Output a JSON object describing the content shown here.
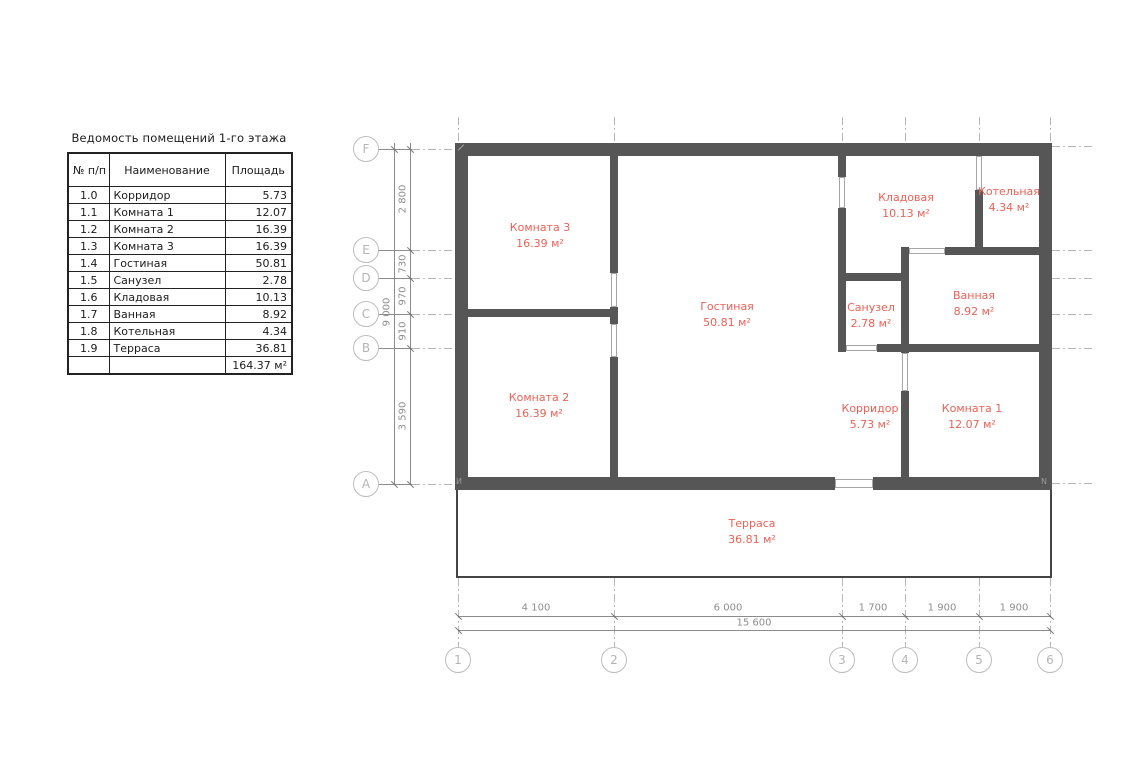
{
  "table": {
    "title": "Ведомость помещений 1-го этажа",
    "headers": {
      "num": "№ п/п",
      "name": "Наименование",
      "area": "Площадь"
    },
    "rows": [
      {
        "num": "1.0",
        "name": "Корридор",
        "area": "5.73"
      },
      {
        "num": "1.1",
        "name": "Комната 1",
        "area": "12.07"
      },
      {
        "num": "1.2",
        "name": "Комната 2",
        "area": "16.39"
      },
      {
        "num": "1.3",
        "name": "Комната 3",
        "area": "16.39"
      },
      {
        "num": "1.4",
        "name": "Гостиная",
        "area": "50.81"
      },
      {
        "num": "1.5",
        "name": "Санузел",
        "area": "2.78"
      },
      {
        "num": "1.6",
        "name": "Кладовая",
        "area": "10.13"
      },
      {
        "num": "1.7",
        "name": "Ванная",
        "area": "8.92"
      },
      {
        "num": "1.8",
        "name": "Котельная",
        "area": "4.34"
      },
      {
        "num": "1.9",
        "name": "Терраса",
        "area": "36.81"
      },
      {
        "num": "",
        "name": "",
        "area": "164.37 м²"
      }
    ]
  },
  "plan": {
    "rooms": {
      "komnata3": {
        "name": "Комната 3",
        "area": "16.39 м²"
      },
      "komnata2": {
        "name": "Комната 2",
        "area": "16.39 м²"
      },
      "gostinaya": {
        "name": "Гостиная",
        "area": "50.81 м²"
      },
      "kladovaya": {
        "name": "Кладовая",
        "area": "10.13 м²"
      },
      "kotelnaya": {
        "name": "Котельная",
        "area": "4.34 м²"
      },
      "sanuzel": {
        "name": "Санузел",
        "area": "2.78 м²"
      },
      "vannaya": {
        "name": "Ванная",
        "area": "8.92 м²"
      },
      "korridor": {
        "name": "Корридор",
        "area": "5.73 м²"
      },
      "komnata1": {
        "name": "Комната 1",
        "area": "12.07 м²"
      },
      "terrasa": {
        "name": "Терраса",
        "area": "36.81 м²"
      }
    },
    "axes": {
      "rows": [
        "F",
        "E",
        "D",
        "C",
        "B",
        "A"
      ],
      "cols": [
        "1",
        "2",
        "3",
        "4",
        "5",
        "6"
      ]
    },
    "dims": {
      "left_segments": [
        "2 800",
        "730",
        "970",
        "910",
        "3 590"
      ],
      "left_total": "9 000",
      "bottom_segments": [
        "4 100",
        "6 000",
        "1 700",
        "1 900",
        "1 900"
      ],
      "bottom_total": "15 600"
    },
    "corner_marks": {
      "bottom_left": "И",
      "bottom_right": "N"
    }
  },
  "colors": {
    "wall": "#565656",
    "room_label": "#ee6156",
    "dim_line": "#8c8c8c",
    "axis_gray": "#b5b5b5",
    "table_ink": "#1c1c1c"
  }
}
